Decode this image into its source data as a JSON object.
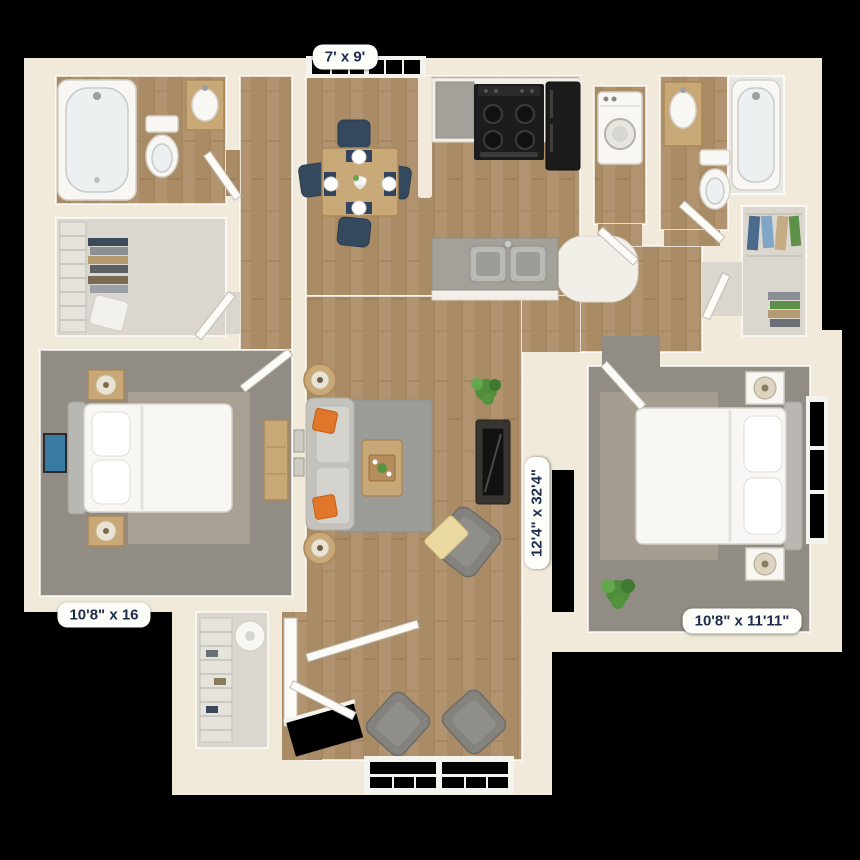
{
  "dimension_labels": {
    "dining_nook": "7' x 9'",
    "bedroom_left": "10'8\" x 16",
    "living_area": "12'4\" x 32'4\"",
    "bedroom_right": "10'8\" x 11'11\""
  },
  "colors": {
    "background": "#000000",
    "wall": "#f1eadb",
    "wood_floor": "#b29370",
    "carpet": "#928d84",
    "label_background": "#fdfdfa",
    "label_text": "#1d2b4c",
    "sofa_pillow_orange": "#e0762a",
    "dining_chair_navy": "#35495e",
    "appliance_black": "#1c1c1c"
  }
}
